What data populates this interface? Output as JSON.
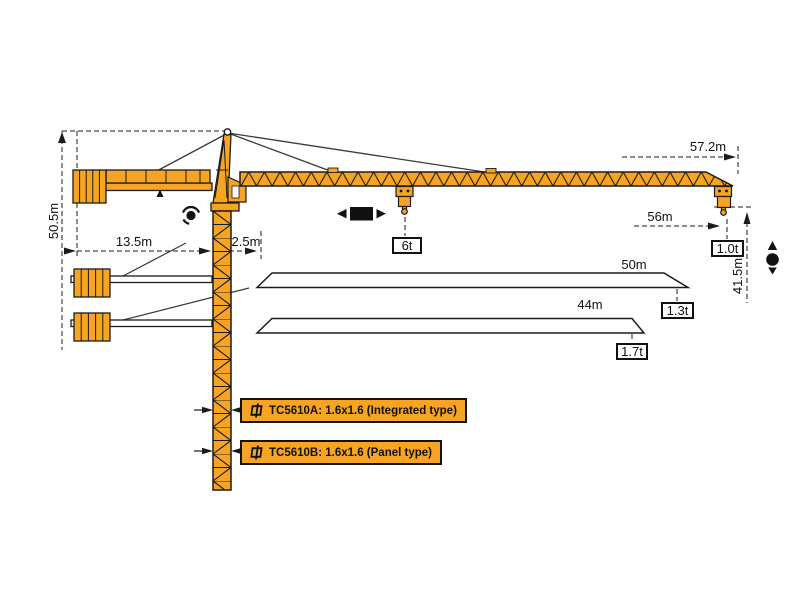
{
  "diagram": {
    "dims": {
      "tower_height": "50.5m",
      "counter_jib_length": "13.5m",
      "rear_clearance": "2.5m",
      "jib_length": "57.2m",
      "max_working_radius": "56m",
      "lifting_height": "41.5m"
    },
    "loads": {
      "rated_mid": "6t",
      "tip_57m": "1.0t"
    },
    "jib_variants": [
      {
        "length": "50m",
        "tip_load": "1.3t"
      },
      {
        "length": "44m",
        "tip_load": "1.7t"
      }
    ],
    "mast_labels": {
      "a": "TC5610A: 1.6x1.6 (Integrated type)",
      "b": "TC5610B: 1.6x1.6 (Panel type)"
    },
    "colors": {
      "crane_orange": "#F7A422",
      "outline": "#1b1b1b"
    }
  }
}
